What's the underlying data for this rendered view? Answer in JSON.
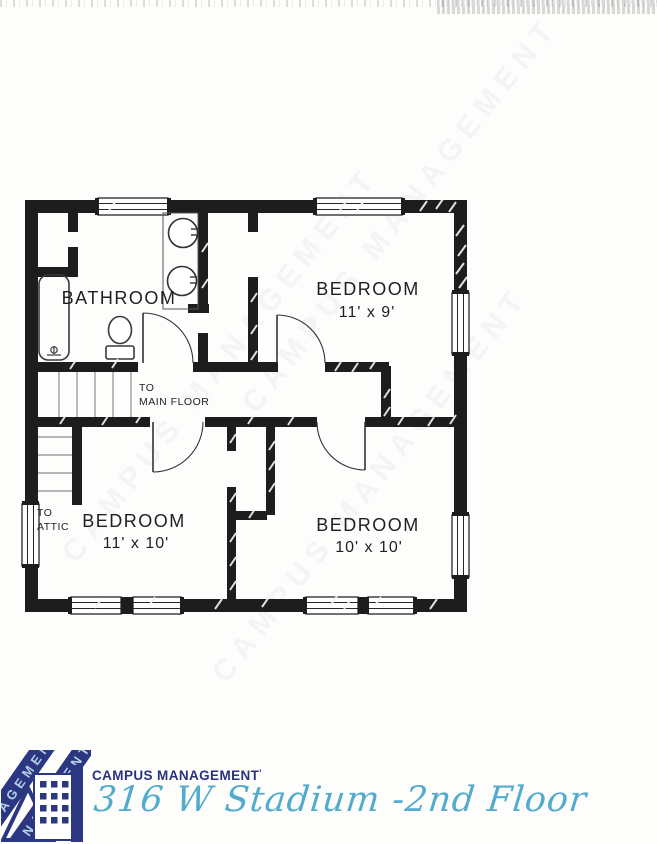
{
  "floor_plan": {
    "labels": {
      "bathroom": "BATHROOM",
      "bedroom_ne": "BEDROOM",
      "bedroom_ne_dims": "11' x 9'",
      "bedroom_sw": "BEDROOM",
      "bedroom_sw_dims": "11' x 10'",
      "bedroom_se": "BEDROOM",
      "bedroom_se_dims": "10' x 10'",
      "to_main_floor_1": "TO",
      "to_main_floor_2": "MAIN FLOOR",
      "to_attic_1": "TO",
      "to_attic_2": "ATTIC"
    },
    "colors": {
      "wall": "#1d1d1d",
      "fixture_line": "#3a3a3a",
      "label_text": "#1f1f1f"
    }
  },
  "watermark": {
    "text": "CAMPUS MANAGEMENT"
  },
  "footer": {
    "brand": "CAMPUS MANAGEMENT",
    "brand_mark": "'",
    "title": "316 W Stadium -2nd Floor",
    "brand_color": "#27337f",
    "title_color": "#53abce",
    "logo_band_text": "MANAGEMENT"
  }
}
